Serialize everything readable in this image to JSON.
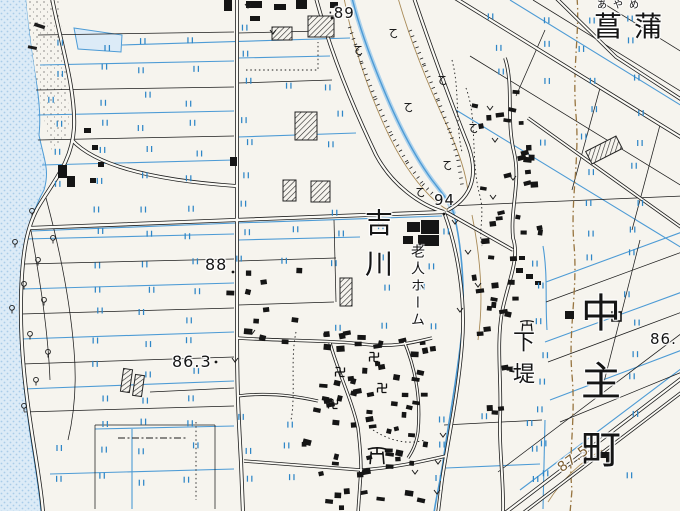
{
  "map": {
    "type": "japanese-topographic-map-scan",
    "labels": {
      "village_ne_furigana": "あやめ",
      "village_ne": "菖蒲",
      "district_center": "吉川",
      "facility": "老人ホーム",
      "hamlet_south": "下堤",
      "town": "中主町"
    },
    "elevations": {
      "pt_89": "·89",
      "pt_94": "94",
      "pt_88": "88",
      "pt_86_3": "86.3",
      "pt_86_right": "86.",
      "contour_87_5": "87.5"
    },
    "symbols": {
      "temple": "manji (卍)",
      "shrine": "torii gate",
      "rice_paddy": "paired blue strokes",
      "dry_field": "v mark",
      "mulberry_field": "te mark",
      "broadleaf_tree": "circle with stem",
      "spot_height": "black dot",
      "monument": "open square"
    },
    "colors": {
      "paper": "#f6f4ee",
      "water_fill": "#dcebf7",
      "water_stipple": "#a9cce9",
      "water_line": "#4d9bd5",
      "paddy_mark": "#2e86c7",
      "contour_brown": "#a98b58",
      "boundary_brown": "#97743f",
      "ink_black": "#1c1c1c",
      "elevation_brown": "#7d5f33"
    }
  }
}
